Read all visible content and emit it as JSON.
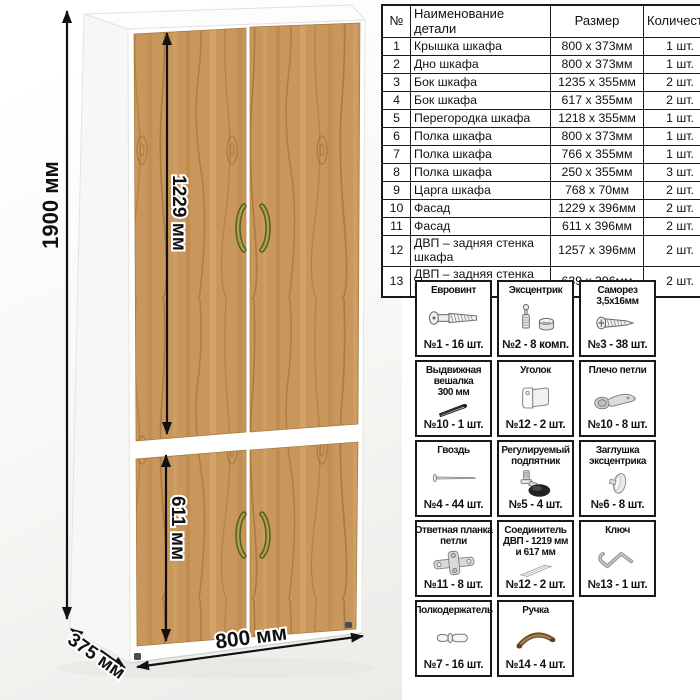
{
  "dimensions": {
    "total_height": "1900 мм",
    "upper_door_height": "1229 мм",
    "lower_door_height": "611 мм",
    "width": "800 мм",
    "depth": "375 мм"
  },
  "parts_table": {
    "headers": [
      "№",
      "Наименование детали",
      "Размер",
      "Количество"
    ],
    "rows": [
      [
        "1",
        "Крышка шкафа",
        "800 x 373мм",
        "1 шт."
      ],
      [
        "2",
        "Дно шкафа",
        "800 x 373мм",
        "1 шт."
      ],
      [
        "3",
        "Бок шкафа",
        "1235 x 355мм",
        "2 шт."
      ],
      [
        "4",
        "Бок шкафа",
        "617 x 355мм",
        "2 шт."
      ],
      [
        "5",
        "Перегородка шкафа",
        "1218 x 355мм",
        "1 шт."
      ],
      [
        "6",
        "Полка шкафа",
        "800 x 373мм",
        "1 шт."
      ],
      [
        "7",
        "Полка шкафа",
        "766 x 355мм",
        "1 шт."
      ],
      [
        "8",
        "Полка шкафа",
        "250 x 355мм",
        "3 шт."
      ],
      [
        "9",
        "Царга шкафа",
        "768 x 70мм",
        "2 шт."
      ],
      [
        "10",
        "Фасад",
        "1229 x 396мм",
        "2 шт."
      ],
      [
        "11",
        "Фасад",
        "611 x 396мм",
        "2 шт."
      ],
      [
        "12",
        "ДВП – задняя стенка шкафа",
        "1257 x 396мм",
        "2 шт."
      ],
      [
        "13",
        "ДВП – задняя стенка шкафа",
        "639 x 396мм",
        "2 шт."
      ]
    ]
  },
  "hardware": {
    "items": [
      {
        "title": "Евровинт",
        "icon": "eurovint-icon",
        "count": "№1 - 16 шт."
      },
      {
        "title": "Эксцентрик",
        "icon": "eccentric-icon",
        "count": "№2 - 8 комп."
      },
      {
        "title": "Саморез\n3,5х16мм",
        "icon": "screw-icon",
        "count": "№3 - 38 шт."
      },
      {
        "title": "Выдвижная\nвешалка\n300 мм",
        "icon": "hanger-rail-icon",
        "count": "№10 - 1 шт."
      },
      {
        "title": "Уголок",
        "icon": "corner-bracket-icon",
        "count": "№12 - 2 шт."
      },
      {
        "title": "Плечо петли",
        "icon": "hinge-arm-icon",
        "count": "№10 - 8 шт."
      },
      {
        "title": "Гвоздь",
        "icon": "nail-icon",
        "count": "№4 - 44 шт."
      },
      {
        "title": "Регулируемый\nподпятник",
        "icon": "adjustable-foot-icon",
        "count": "№5 - 4 шт."
      },
      {
        "title": "Заглушка\nэксцентрика",
        "icon": "eccentric-cap-icon",
        "count": "№6 - 8 шт."
      },
      {
        "title": "Ответная планка\nпетли",
        "icon": "hinge-plate-icon",
        "count": "№11 - 8 шт."
      },
      {
        "title": "Соединитель\nДВП - 1219 мм\nи 617 мм",
        "icon": "dvp-connector-icon",
        "count": "№12 - 2 шт."
      },
      {
        "title": "Ключ",
        "icon": "hex-key-icon",
        "count": "№13 - 1 шт."
      },
      {
        "title": "Полкодержатель",
        "icon": "shelf-pin-icon",
        "count": "№7 - 16 шт."
      },
      {
        "title": "Ручка",
        "icon": "handle-icon",
        "count": "№14 - 4 шт."
      }
    ]
  },
  "colors": {
    "wood": "#c9965c",
    "wood_grain_dark": "#a87338",
    "carcass_white": "#fdfdfd",
    "handle_bronze": "#8b8840",
    "dimension_line": "#111111",
    "table_border": "#1a1a1a",
    "background": "#ffffff"
  }
}
